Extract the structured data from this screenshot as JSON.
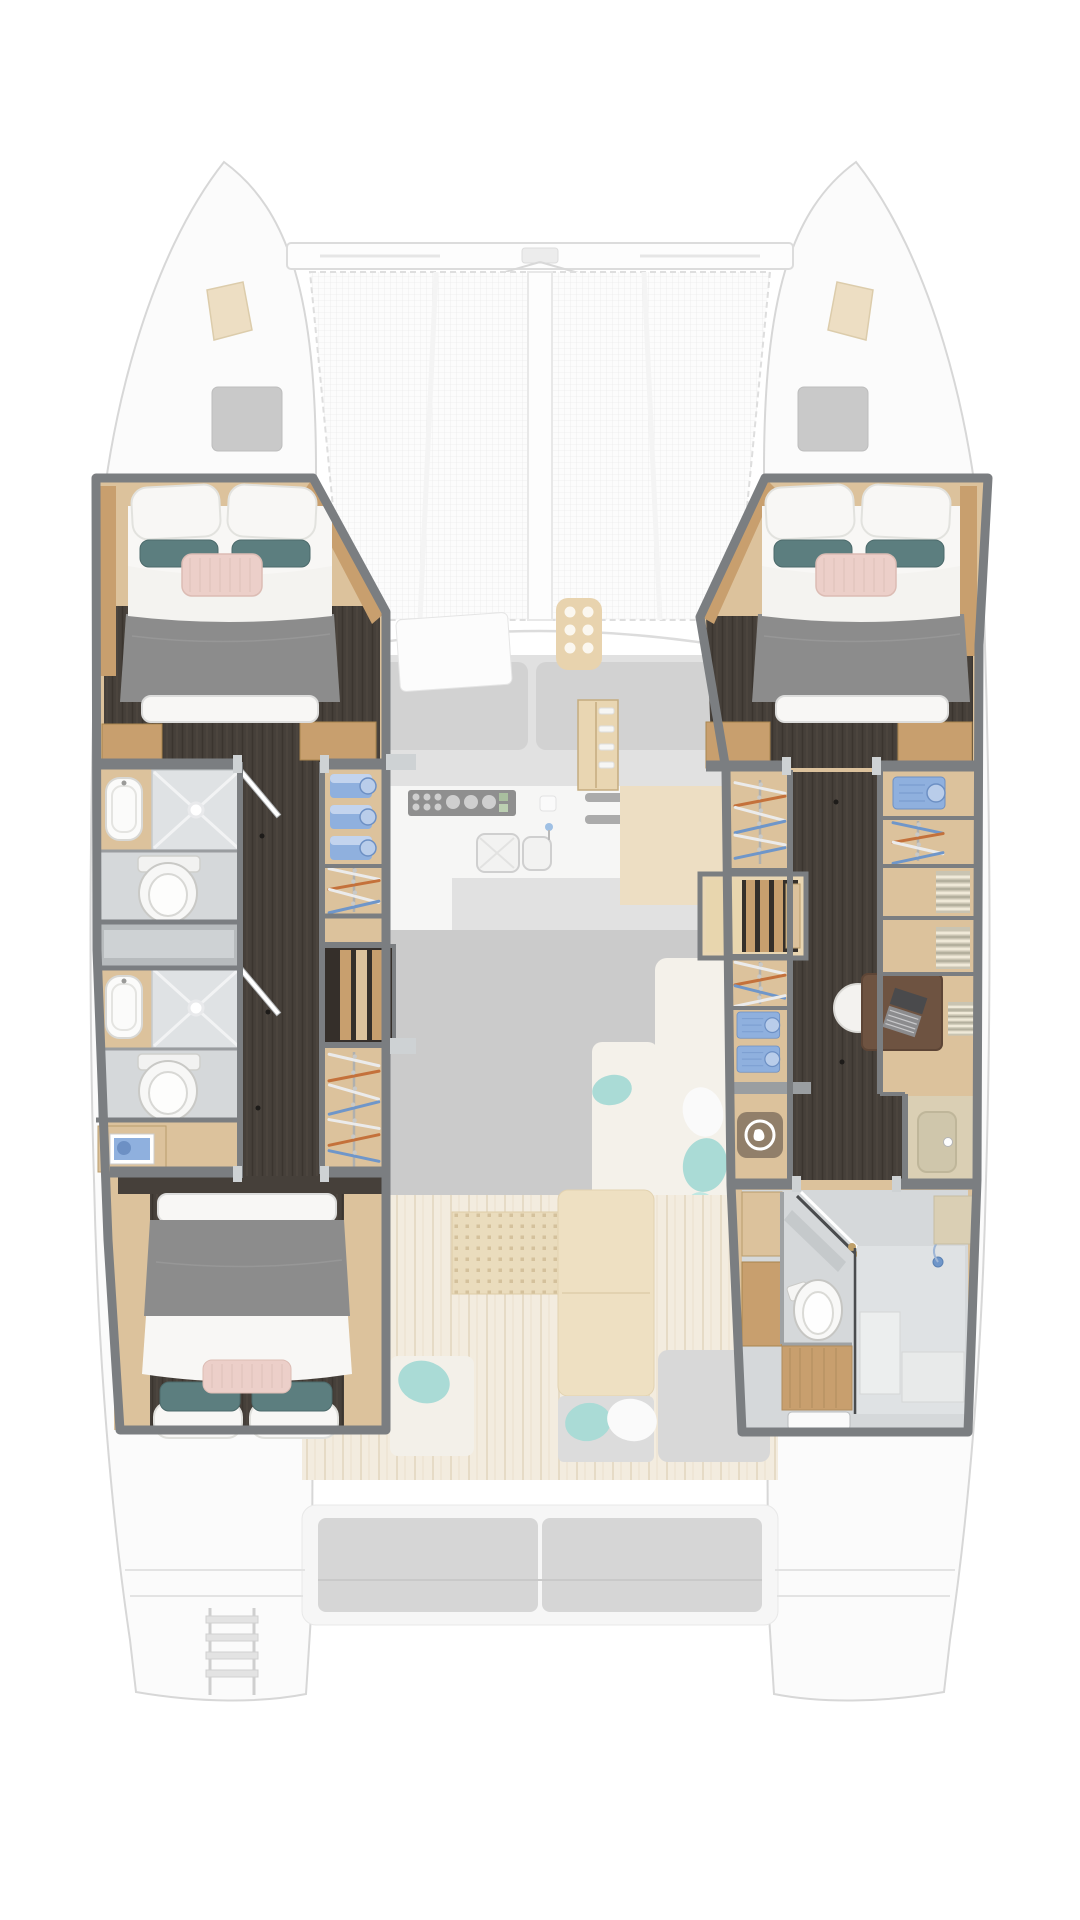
{
  "meta": {
    "title": "Catamaran lower deck floor plan",
    "view": "top-down",
    "orientation": "bow-up",
    "highlight": "hull accommodation areas in full color; saloon, foredeck and cockpit faded"
  },
  "palette": {
    "background": "#ffffff",
    "hull_outline": "#d7d7d7",
    "faded_white": "#fbfbfb",
    "faded_gray": "#e1e1e1",
    "faded_gray2": "#d2d2d2",
    "faded_wood": "#eddec3",
    "mesh_line": "#e9e9e9",
    "aqua": "#aadbd6",
    "wall_gray": "#7b7e81",
    "wall_light": "#9a9ea1",
    "wood_light": "#dcc29c",
    "wood_mid": "#c89f6e",
    "wood_pale": "#e9d6b2",
    "dark_floor": "#46403a",
    "dark_floor2": "#352f2a",
    "bath_floor": "#d5d8da",
    "shower_tile": "#dfe2e4",
    "cabinet_gray": "#b7bbbd",
    "cabinet_gray_light": "#ced2d4",
    "white_soft": "#f8f7f5",
    "blanket_gray": "#8c8c8c",
    "pillow_teal": "#5c7e7f",
    "pillow_blush": "#eccfc9",
    "cloth_blue": "#8fb0de",
    "cloth_blue_dark": "#6d90c4",
    "hanger_orange": "#c4713b",
    "hanger_blue": "#6f96c9",
    "hanger_white": "#ebebeb",
    "desk_brown": "#6e5341",
    "vanity_beige": "#dacfb4",
    "wash_icon": "#8b7a66"
  },
  "regions": {
    "foredeck": {
      "state": "faded",
      "items": [
        "port-bow-hull",
        "starboard-bow-hull",
        "crossbeam",
        "bow-stay-lines",
        "trampoline-net",
        "center-beam",
        "deck-hatch-port",
        "deck-hatch-starboard",
        "anchor-locker-lid-port",
        "anchor-locker-lid-starboard"
      ]
    },
    "saloon": {
      "state": "faded",
      "items": [
        "forward-sunpad-cushions",
        "forward-hatch",
        "control-panel",
        "galley-cooktop",
        "galley-double-sink",
        "galley-counters",
        "vent-grilles",
        "l-shaped-sofa",
        "scatter-cushions-aqua",
        "hull-steps-cabinet"
      ]
    },
    "cockpit": {
      "state": "faded",
      "items": [
        "teak-deck",
        "perforated-mat",
        "dining-table",
        "bench-seat-port",
        "bench-seat-aft-of-table",
        "bench-seat-starboard",
        "aft-sofa-two-cushions",
        "swim-ladder",
        "transom-platforms"
      ]
    },
    "port_hull": {
      "state": "highlighted",
      "rooms": [
        {
          "name": "forward-cabin",
          "furniture": [
            "island-double-berth"
          ],
          "bedding": {
            "white_pillows": 2,
            "teal_cushions": 2,
            "blush_cushion": 1,
            "duvet": "white",
            "foot_runner": "gray"
          }
        },
        {
          "name": "forward-bathroom",
          "fixtures": [
            "washbasin",
            "shower-cabin",
            "ceiling-spotlight",
            "toilet",
            "swing-door"
          ]
        },
        {
          "name": "midship-locker",
          "fixtures": [
            "gray-cabinet"
          ]
        },
        {
          "name": "aft-bathroom",
          "fixtures": [
            "washbasin",
            "shower-cabin",
            "ceiling-spotlight",
            "toilet",
            "swing-door"
          ]
        },
        {
          "name": "vanity-nook",
          "fixtures": [
            "blue-art-panel"
          ]
        },
        {
          "name": "wardrobe-column",
          "towel_stacks": 3,
          "hangers_forward": 4,
          "hangers_aft": 7,
          "fixtures": [
            "towel-shelves",
            "hanging-locker-forward",
            "companionway-steps",
            "hanging-locker-aft"
          ]
        },
        {
          "name": "aft-cabin",
          "furniture": [
            "double-berth"
          ],
          "bedding": {
            "white_pillows": 2,
            "teal_cushions": 2,
            "blush_cushion": 1,
            "duvet_head": "gray",
            "duvet_foot": "white"
          }
        },
        {
          "name": "corridor",
          "floor": "dark-oak"
        }
      ]
    },
    "starboard_hull": {
      "state": "highlighted",
      "rooms": [
        {
          "name": "forward-cabin",
          "furniture": [
            "island-double-berth"
          ],
          "bedding": {
            "white_pillows": 2,
            "teal_cushions": 2,
            "blush_cushion": 1,
            "duvet": "white",
            "foot_runner": "gray"
          }
        },
        {
          "name": "wardrobe-column-inboard",
          "hangers_forward": 6,
          "hangers_mid": 4,
          "shirt_shelves": 2,
          "fixtures": [
            "hanging-locker",
            "companionway-steps",
            "hanging-locker-2",
            "folded-shirt-shelves",
            "washing-machine-locker"
          ]
        },
        {
          "name": "dressing-outboard",
          "fixtures": [
            "shirt-cubby",
            "hanging-locker",
            "linen-shelf",
            "linen-shelf-2"
          ]
        },
        {
          "name": "office",
          "furniture": [
            "desk",
            "round-stool",
            "laptop",
            "linen-shelf"
          ]
        },
        {
          "name": "vanity",
          "fixtures": [
            "inset-washbasin",
            "mixer-tap"
          ]
        },
        {
          "name": "aft-bathroom",
          "fixtures": [
            "toilet",
            "mirror-cabinet",
            "swing-door",
            "shower-cabin",
            "shower-head",
            "teak-mat",
            "entry-step",
            "storage-lockers"
          ]
        },
        {
          "name": "corridor",
          "floor": "dark-oak"
        }
      ]
    }
  },
  "icons": [
    {
      "name": "washing-machine-icon",
      "style": "rounded square with white porthole ring",
      "color": "#8b7a66"
    },
    {
      "name": "spotlight-icon",
      "style": "white glow dot in shower ceiling"
    },
    {
      "name": "shower-head-icon",
      "color": "#6f96c9"
    }
  ]
}
